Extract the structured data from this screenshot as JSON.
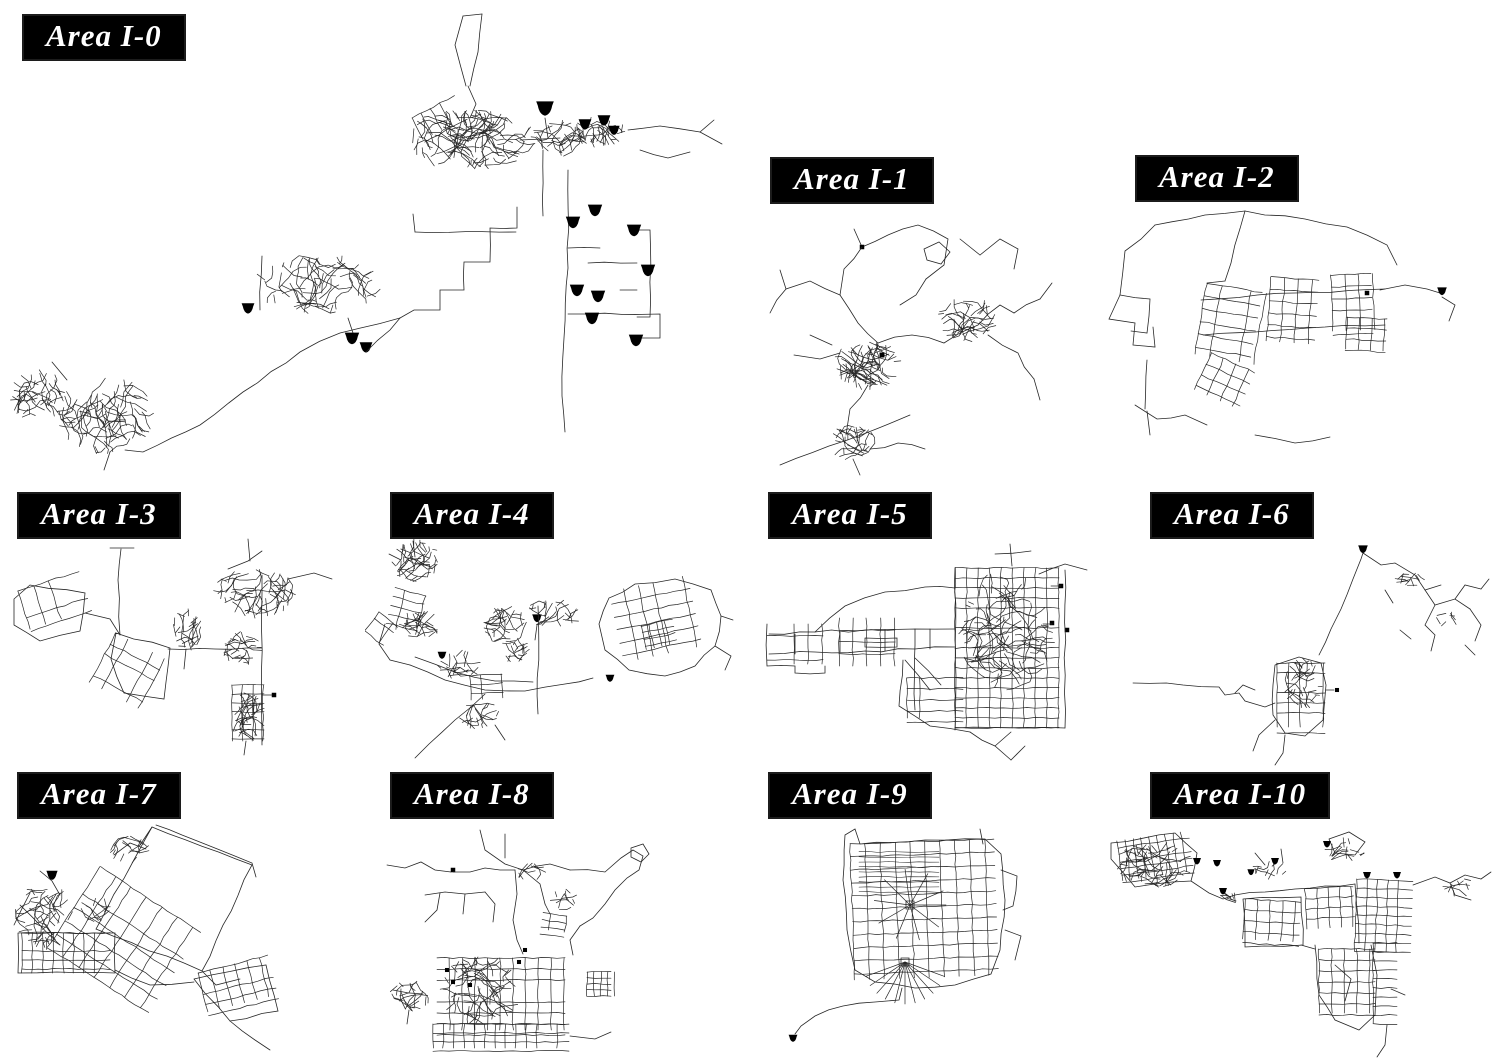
{
  "figure": {
    "type": "road-network-map-panels",
    "background": "#ffffff",
    "line_color": "#262626",
    "marker_color": "#000000",
    "label_style": {
      "background": "#000000",
      "text_color": "#ffffff"
    }
  },
  "panels": [
    {
      "id": "area-i-0",
      "label": "Area I-0"
    },
    {
      "id": "area-i-1",
      "label": "Area I-1"
    },
    {
      "id": "area-i-2",
      "label": "Area I-2"
    },
    {
      "id": "area-i-3",
      "label": "Area I-3"
    },
    {
      "id": "area-i-4",
      "label": "Area I-4"
    },
    {
      "id": "area-i-5",
      "label": "Area I-5"
    },
    {
      "id": "area-i-6",
      "label": "Area I-6"
    },
    {
      "id": "area-i-7",
      "label": "Area I-7"
    },
    {
      "id": "area-i-8",
      "label": "Area I-8"
    },
    {
      "id": "area-i-9",
      "label": "Area I-9"
    },
    {
      "id": "area-i-10",
      "label": "Area I-10"
    }
  ]
}
